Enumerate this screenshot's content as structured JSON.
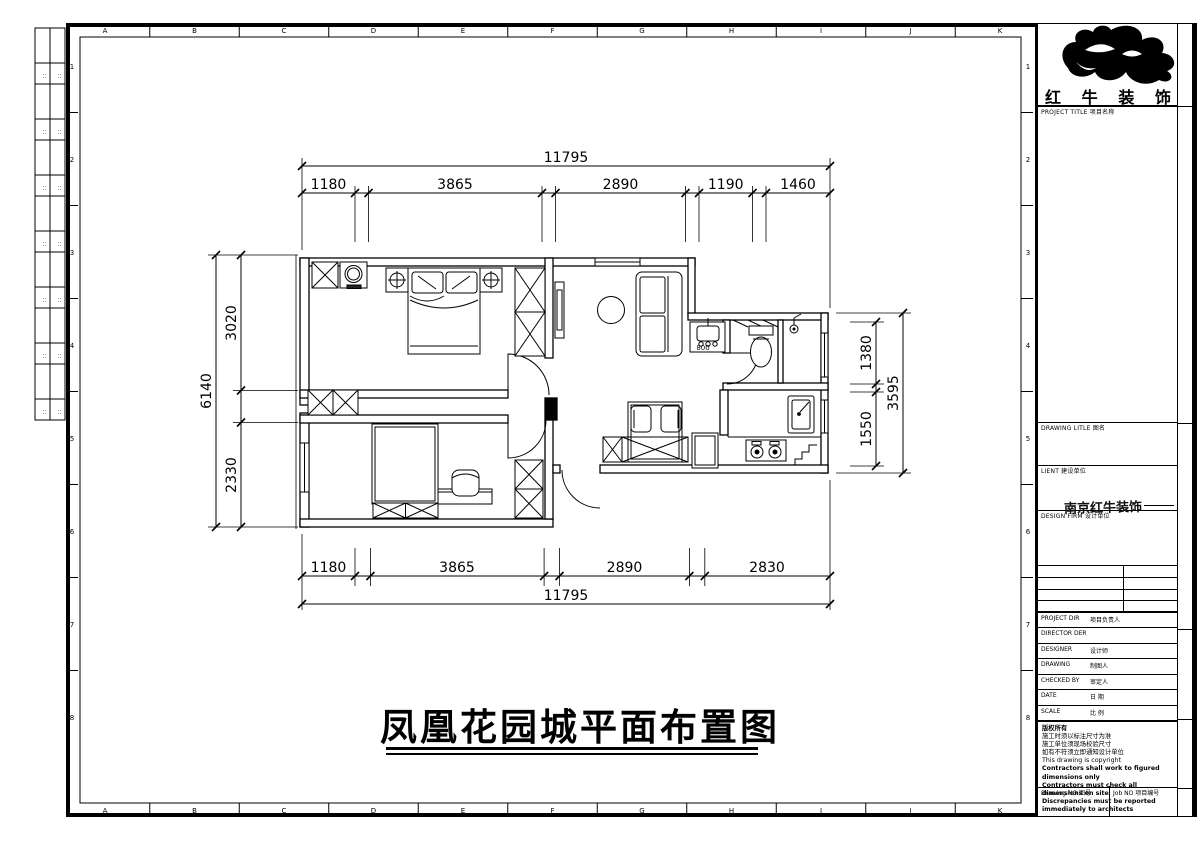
{
  "sheet": {
    "grid_letters": [
      "A",
      "B",
      "C",
      "D",
      "E",
      "F",
      "G",
      "H",
      "I",
      "J",
      "K"
    ],
    "grid_numbers": [
      "1",
      "2",
      "3",
      "4",
      "5",
      "6",
      "7",
      "8"
    ],
    "strip_mark": "∷"
  },
  "main_title": "凤凰花园城平面布置图",
  "brand": {
    "name": "红牛装饰",
    "chars": [
      "红",
      "牛",
      "装",
      "饰"
    ]
  },
  "title_block": {
    "project_title_label": "PROJECT TITLE  项目名称",
    "drawing_title_label": "DRAWING LITLE  图名",
    "client_label": "LIENT  建设单位",
    "design_firm_label": "DESIGN FIRM  设计单位",
    "design_firm_stamp": "南京红牛装饰",
    "rows": [
      {
        "en": "PROJECT DIR",
        "cn": "项目负责人"
      },
      {
        "en": "DIRECTOR DER",
        "cn": ""
      },
      {
        "en": "DESIGNER",
        "cn": "设计师"
      },
      {
        "en": "DRAWING",
        "cn": "制图人"
      },
      {
        "en": "CHECKED BY",
        "cn": "审定人"
      },
      {
        "en": "DATE",
        "cn": "日 期"
      },
      {
        "en": "SCALE",
        "cn": "比 例"
      }
    ],
    "notes": [
      "版权所有",
      "施工时须以标注尺寸为准",
      "施工单位须现场校验尺寸",
      "如有不符须立即通知设计单位",
      "This drawing is copyright",
      "Contractors shall work to figured dimensions only",
      "Contractors must check all dimensions on site",
      "Discrepancies must be reported immediately to architects"
    ],
    "drawing_no_label": "Drawing NO  图号",
    "job_no_label": "Job NO  项目编号"
  },
  "dimensions": {
    "top": {
      "overall": "11795",
      "segments": [
        "1180",
        "3865",
        "2890",
        "1190",
        "1460"
      ]
    },
    "bottom": {
      "overall": "11795",
      "segments": [
        "1180",
        "3865",
        "2890",
        "2830"
      ]
    },
    "left": {
      "overall": "6140",
      "segments": [
        "3020",
        "2330"
      ]
    },
    "right": {
      "overall": "3595",
      "segments": [
        "1380",
        "1550"
      ]
    }
  },
  "plan_labels": {
    "vanity_width": "800"
  }
}
